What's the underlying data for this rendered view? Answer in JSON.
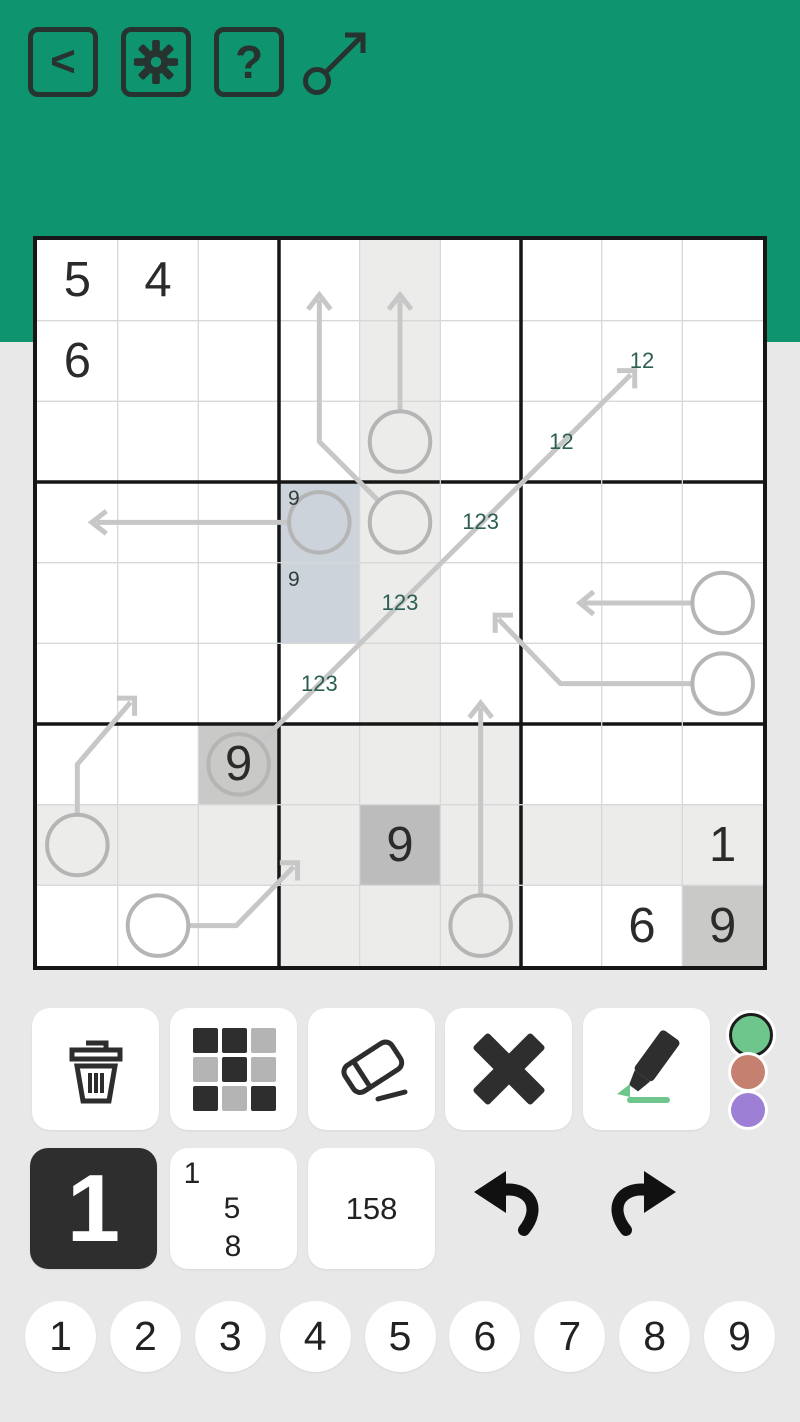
{
  "colors": {
    "header_bg": "#0e946f",
    "page_bg": "#e8e8e8",
    "icon_dark": "#27332f",
    "tool_icon_dark": "#2d2d2d",
    "tool_icon_light": "#b4b4b4",
    "grid_line": "#d8d8d8",
    "grid_bold": "#161616",
    "cell_highlight_light": "#ececea",
    "cell_highlight_same_digit": "#c9c9c7",
    "cell_selected": "#bcbcbc",
    "cell_colored_blue": "#ccd3da",
    "given_text": "#2b2b2b",
    "center_mark_text": "#2c5f53",
    "corner_mark_text": "#2e3f3a",
    "arrow_stroke": "#c7c7c7",
    "circle_stroke": "#b5b5b5",
    "dot_green": "#6fc68c",
    "dot_red": "#c5806f",
    "dot_purple": "#9d7fd6",
    "marker_green": "#6fc68c"
  },
  "header": {
    "back_glyph": "<",
    "help_glyph": "?",
    "buttons": [
      "back",
      "settings",
      "help"
    ],
    "puzzle_type": "arrow-sudoku"
  },
  "grid": {
    "size": 9,
    "givens": [
      [
        1,
        1,
        "5"
      ],
      [
        1,
        2,
        "4"
      ],
      [
        2,
        1,
        "6"
      ],
      [
        7,
        3,
        "9"
      ],
      [
        8,
        5,
        "9"
      ],
      [
        8,
        9,
        "1"
      ],
      [
        9,
        8,
        "6"
      ],
      [
        9,
        9,
        "9"
      ]
    ],
    "center_marks": [
      [
        2,
        8,
        "12"
      ],
      [
        3,
        7,
        "12"
      ],
      [
        4,
        6,
        "123"
      ],
      [
        5,
        5,
        "123"
      ],
      [
        6,
        4,
        "123"
      ]
    ],
    "corner_marks": [
      [
        4,
        4,
        "9"
      ],
      [
        5,
        4,
        "9"
      ]
    ],
    "shaded_light": [
      [
        1,
        5
      ],
      [
        2,
        5
      ],
      [
        3,
        5
      ],
      [
        4,
        5
      ],
      [
        5,
        5
      ],
      [
        6,
        5
      ],
      [
        7,
        4
      ],
      [
        7,
        5
      ],
      [
        7,
        6
      ],
      [
        8,
        1
      ],
      [
        8,
        2
      ],
      [
        8,
        3
      ],
      [
        8,
        4
      ],
      [
        8,
        6
      ],
      [
        8,
        7
      ],
      [
        8,
        8
      ],
      [
        8,
        9
      ],
      [
        9,
        4
      ],
      [
        9,
        5
      ],
      [
        9,
        6
      ]
    ],
    "shaded_same_digit": [
      [
        7,
        3
      ],
      [
        9,
        9
      ]
    ],
    "selected_cell": [
      [
        8,
        5
      ]
    ],
    "colored_cells": [
      [
        4,
        4
      ],
      [
        5,
        4
      ]
    ],
    "circles": [
      [
        3,
        5
      ],
      [
        4,
        4
      ],
      [
        4,
        5
      ],
      [
        5,
        9
      ],
      [
        6,
        9
      ],
      [
        7,
        3
      ],
      [
        8,
        1
      ],
      [
        9,
        2
      ],
      [
        9,
        6
      ]
    ],
    "arrows": [
      {
        "shaft": [
          [
            4.5,
            2.12
          ],
          [
            4.5,
            0.74
          ]
        ],
        "head": [
          [
            4.36,
            0.86
          ],
          [
            4.5,
            0.68
          ],
          [
            4.64,
            0.86
          ]
        ]
      },
      {
        "shaft": [
          [
            4.23,
            3.23
          ],
          [
            3.5,
            2.5
          ],
          [
            3.5,
            0.74
          ]
        ],
        "head": [
          [
            3.36,
            0.86
          ],
          [
            3.5,
            0.68
          ],
          [
            3.64,
            0.86
          ]
        ]
      },
      {
        "shaft": [
          [
            3.12,
            3.5
          ],
          [
            0.74,
            3.5
          ]
        ],
        "head": [
          [
            0.86,
            3.36
          ],
          [
            0.68,
            3.5
          ],
          [
            0.86,
            3.64
          ]
        ]
      },
      {
        "shaft": [
          [
            2.77,
            6.23
          ],
          [
            7.36,
            1.67
          ]
        ],
        "head": [
          [
            7.19,
            1.62
          ],
          [
            7.41,
            1.62
          ],
          [
            7.41,
            1.84
          ]
        ]
      },
      {
        "shaft": [
          [
            8.12,
            4.5
          ],
          [
            6.78,
            4.5
          ]
        ],
        "head": [
          [
            6.9,
            4.36
          ],
          [
            6.73,
            4.5
          ],
          [
            6.9,
            4.64
          ]
        ]
      },
      {
        "shaft": [
          [
            8.12,
            5.5
          ],
          [
            6.49,
            5.5
          ],
          [
            5.72,
            4.7
          ]
        ],
        "head": [
          [
            5.9,
            4.65
          ],
          [
            5.68,
            4.65
          ],
          [
            5.68,
            4.87
          ]
        ]
      },
      {
        "shaft": [
          [
            0.5,
            7.12
          ],
          [
            0.5,
            6.5
          ],
          [
            1.16,
            5.73
          ]
        ],
        "head": [
          [
            0.99,
            5.68
          ],
          [
            1.21,
            5.68
          ],
          [
            1.21,
            5.9
          ]
        ]
      },
      {
        "shaft": [
          [
            1.88,
            8.5
          ],
          [
            2.47,
            8.5
          ],
          [
            3.18,
            7.77
          ]
        ],
        "head": [
          [
            3.01,
            7.72
          ],
          [
            3.23,
            7.72
          ],
          [
            3.23,
            7.94
          ]
        ]
      },
      {
        "shaft": [
          [
            5.5,
            8.12
          ],
          [
            5.5,
            5.8
          ]
        ],
        "head": [
          [
            5.36,
            5.92
          ],
          [
            5.5,
            5.74
          ],
          [
            5.64,
            5.92
          ]
        ]
      }
    ]
  },
  "tools": {
    "items": [
      "delete",
      "color-grid",
      "eraser",
      "close",
      "marker"
    ],
    "palette": [
      {
        "id": "green",
        "color": "#6fc68c",
        "selected": true
      },
      {
        "id": "red",
        "color": "#c5806f",
        "selected": false
      },
      {
        "id": "purple",
        "color": "#9d7fd6",
        "selected": false
      }
    ]
  },
  "entry": {
    "big_value": "1",
    "corner_values": [
      "1",
      "5",
      "8"
    ],
    "center_value": "158"
  },
  "digits": [
    "1",
    "2",
    "3",
    "4",
    "5",
    "6",
    "7",
    "8",
    "9"
  ]
}
